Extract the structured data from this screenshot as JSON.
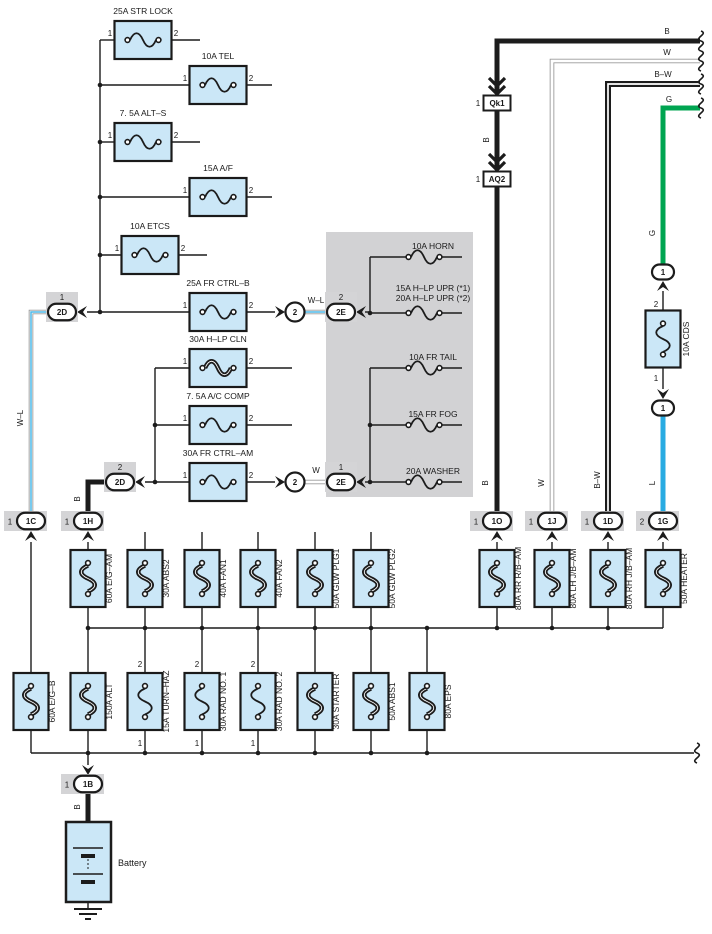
{
  "colors": {
    "black": "#1c1c1c",
    "fuse_fill": "#cbe7f7",
    "fuse_border": "#1a1a1a",
    "panel_gray": "#d2d2d4",
    "conn_gray": "#d4d4d6",
    "wire_edge": "#9b9b9b",
    "green": "#00a551",
    "blue": "#29abe2",
    "stripe_blue": "#4cb8e8"
  },
  "left_fuses": [
    {
      "label": "25A STR LOCK",
      "pin_left": "1",
      "pin_right": "2",
      "cx": 143,
      "y": 40,
      "left": 100,
      "right": 200,
      "thick": false
    },
    {
      "label": "10A TEL",
      "pin_left": "1",
      "pin_right": "2",
      "cx": 218,
      "y": 85,
      "left": 100,
      "right": 272,
      "thick": false
    },
    {
      "label": "7. 5A ALT–S",
      "pin_left": "1",
      "pin_right": "2",
      "cx": 143,
      "y": 142,
      "left": 100,
      "right": 200,
      "thick": false
    },
    {
      "label": "15A A/F",
      "pin_left": "1",
      "pin_right": "2",
      "cx": 218,
      "y": 197,
      "left": 100,
      "right": 272,
      "thick": false
    },
    {
      "label": "10A ETCS",
      "pin_left": "1",
      "pin_right": "2",
      "cx": 150,
      "y": 255,
      "left": 100,
      "right": 207,
      "thick": false
    },
    {
      "label": "25A FR CTRL–B",
      "pin_left": "1",
      "pin_right": "2",
      "cx": 218,
      "y": 312,
      "left": null,
      "right": null,
      "thick": false
    },
    {
      "label": "30A H–LP CLN",
      "pin_left": "1",
      "pin_right": "2",
      "cx": 218,
      "y": 368,
      "left": 155,
      "right": 292,
      "thick": true
    },
    {
      "label": "7. 5A A/C COMP",
      "pin_left": "1",
      "pin_right": "2",
      "cx": 218,
      "y": 425,
      "left": 155,
      "right": 292,
      "thick": false
    },
    {
      "label": "30A FR CTRL–AM",
      "pin_left": "1",
      "pin_right": "2",
      "cx": 218,
      "y": 482,
      "left": null,
      "right": null,
      "thick": false
    }
  ],
  "gray_panel_fuses": [
    {
      "label": "10A HORN",
      "y": 257
    },
    {
      "label": "15A H–LP UPR (*1)",
      "label2": "20A H–LP UPR (*2)",
      "y": 313
    },
    {
      "label": "10A FR TAIL",
      "y": 368
    },
    {
      "label": "15A FR FOG",
      "y": 425
    },
    {
      "label": "20A WASHER",
      "y": 482
    }
  ],
  "row1_fuses": [
    {
      "label": "60A E/G–AM",
      "cx": 88
    },
    {
      "label": "30A ABS2",
      "cx": 145
    },
    {
      "label": "40A FAN1",
      "cx": 202
    },
    {
      "label": "40A FAN2",
      "cx": 258
    },
    {
      "label": "50A GLW PLG1",
      "cx": 315
    },
    {
      "label": "50A GLW PLG2",
      "cx": 371
    },
    {
      "label": "80A RR R/B–AM",
      "cx": 497
    },
    {
      "label": "80A LH J/B–AM",
      "cx": 552
    },
    {
      "label": "80A RH J/B–AM",
      "cx": 608
    },
    {
      "label": "50A HEATER",
      "cx": 663
    }
  ],
  "row2_fuses": [
    {
      "label": "60A E/G–B",
      "cx": 31,
      "thick": true
    },
    {
      "label": "150A ALT",
      "cx": 88,
      "thick": true
    },
    {
      "label": "15A TURN–HAZ",
      "cx": 145,
      "thick": false,
      "pin_top": "2",
      "pin_bottom": "1"
    },
    {
      "label": "30A RAD NO. 1",
      "cx": 202,
      "thick": false,
      "pin_top": "2",
      "pin_bottom": "1"
    },
    {
      "label": "30A RAD NO. 2",
      "cx": 258,
      "thick": false,
      "pin_top": "2",
      "pin_bottom": "1"
    },
    {
      "label": "30A STARTER",
      "cx": 315,
      "thick": true
    },
    {
      "label": "50A ABS1",
      "cx": 371,
      "thick": true
    },
    {
      "label": "80A EPS",
      "cx": 427,
      "thick": true
    }
  ],
  "cds_fuse": {
    "label": "10A CDS",
    "pin_top": "2",
    "pin_bottom": "1"
  },
  "bottom_connectors": [
    {
      "code": "1C",
      "pin": "1",
      "cx": 31
    },
    {
      "code": "1H",
      "pin": "1",
      "cx": 88
    },
    {
      "code": "1O",
      "pin": "1",
      "cx": 497
    },
    {
      "code": "1J",
      "pin": "1",
      "cx": 552
    },
    {
      "code": "1D",
      "pin": "1",
      "cx": 608
    },
    {
      "code": "1G",
      "pin": "2",
      "cx": 663
    }
  ],
  "inline_connectors": [
    {
      "code": "2D",
      "pin": "1",
      "cx": 62,
      "cy": 312
    },
    {
      "code": "2D",
      "pin": "2",
      "cx": 120,
      "cy": 482
    },
    {
      "code": "2E",
      "pin": "2",
      "cx": 341,
      "cy": 312
    },
    {
      "code": "2E",
      "pin": "1",
      "cx": 341,
      "cy": 482
    }
  ],
  "round_connectors": [
    {
      "code": "2",
      "cx": 295,
      "cy": 312
    },
    {
      "code": "2",
      "cx": 295,
      "cy": 482
    }
  ],
  "small_oval_connectors": [
    {
      "code": "1",
      "cx": 663,
      "cy": 272
    },
    {
      "code": "1",
      "cx": 663,
      "cy": 408
    }
  ],
  "rect_connectors": [
    {
      "code": "Qk1",
      "pin": "1",
      "cx": 497,
      "cy": 103
    },
    {
      "code": "AQ2",
      "pin": "1",
      "cx": 497,
      "cy": 179
    }
  ],
  "battery_connector": {
    "code": "1B",
    "pin": "1",
    "cx": 88,
    "cy": 784
  },
  "battery": {
    "label": "Battery"
  },
  "wire_labels": [
    {
      "text": "B",
      "x": 667,
      "y": 34,
      "vert": false
    },
    {
      "text": "W",
      "x": 667,
      "y": 55,
      "vert": false
    },
    {
      "text": "B–W",
      "x": 663,
      "y": 77,
      "vert": false
    },
    {
      "text": "G",
      "x": 669,
      "y": 102,
      "vert": false
    },
    {
      "text": "B",
      "x": 489,
      "y": 140,
      "vert": true
    },
    {
      "text": "W–L",
      "x": 316,
      "y": 303,
      "vert": false
    },
    {
      "text": "W",
      "x": 316,
      "y": 473,
      "vert": false
    },
    {
      "text": "W–L",
      "x": 23,
      "y": 418,
      "vert": true
    },
    {
      "text": "B",
      "x": 80,
      "y": 499,
      "vert": true
    },
    {
      "text": "B",
      "x": 488,
      "y": 483,
      "vert": true
    },
    {
      "text": "W",
      "x": 544,
      "y": 483,
      "vert": true
    },
    {
      "text": "B–W",
      "x": 600,
      "y": 480,
      "vert": true
    },
    {
      "text": "G",
      "x": 655,
      "y": 233,
      "vert": true
    },
    {
      "text": "L",
      "x": 655,
      "y": 483,
      "vert": true
    },
    {
      "text": "B",
      "x": 80,
      "y": 807,
      "vert": true
    }
  ]
}
